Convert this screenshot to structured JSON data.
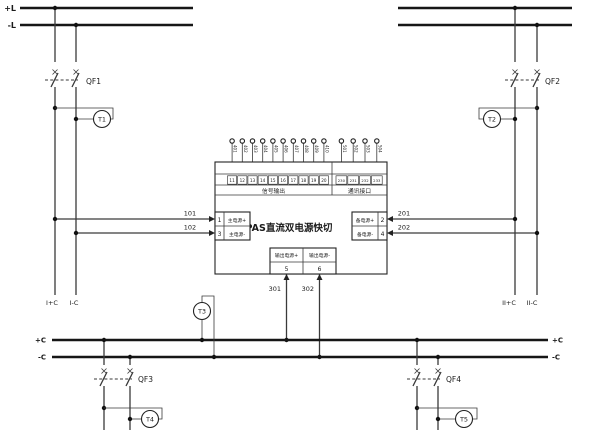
{
  "diagram": {
    "buses": {
      "pos_top": "+L",
      "neg_top": "-L",
      "pos_bottom_left": "+C",
      "neg_bottom_left": "-C",
      "pos_bottom_right": "+C",
      "neg_bottom_right": "-C"
    },
    "breakers": {
      "qf1": "QF1",
      "qf2": "QF2",
      "qf3": "QF3",
      "qf4": "QF4"
    },
    "indicators": {
      "t1": "T1",
      "t2": "T2",
      "t3": "T3",
      "t4": "T4",
      "t5": "T5"
    },
    "wires": {
      "w101": "101",
      "w102": "102",
      "w201": "201",
      "w202": "202",
      "w301": "301",
      "w302": "302"
    },
    "feeders": {
      "left_pos": "I+C",
      "left_neg": "I-C",
      "right_pos": "II+C",
      "right_neg": "II-C"
    },
    "device": {
      "title": "DPAS直流双电源快切",
      "sections": {
        "signal": "信号输出",
        "comm": "通讯接口"
      },
      "terminals": {
        "main_pos": {
          "num": "1",
          "label": "主电源+"
        },
        "main_neg": {
          "num": "3",
          "label": "主电源-"
        },
        "backup_pos": {
          "num": "2",
          "label": "备电源+"
        },
        "backup_neg": {
          "num": "4",
          "label": "备电源-"
        },
        "out_pos": {
          "num": "5",
          "label": "输出电源+"
        },
        "out_neg": {
          "num": "6",
          "label": "输出电源-"
        }
      },
      "signal_cells": [
        "11",
        "12",
        "13",
        "14",
        "15",
        "16",
        "17",
        "18",
        "19",
        "20"
      ],
      "comm_cells": [
        "230",
        "231",
        "232",
        "233"
      ],
      "signal_tags": [
        "401",
        "402",
        "403",
        "404",
        "405",
        "406",
        "407",
        "408",
        "409",
        "410"
      ],
      "comm_tags": [
        "501",
        "502",
        "503",
        "504"
      ]
    },
    "colors": {
      "line": "#3a3a3a",
      "bus": "#161616",
      "background": "#ffffff"
    }
  }
}
